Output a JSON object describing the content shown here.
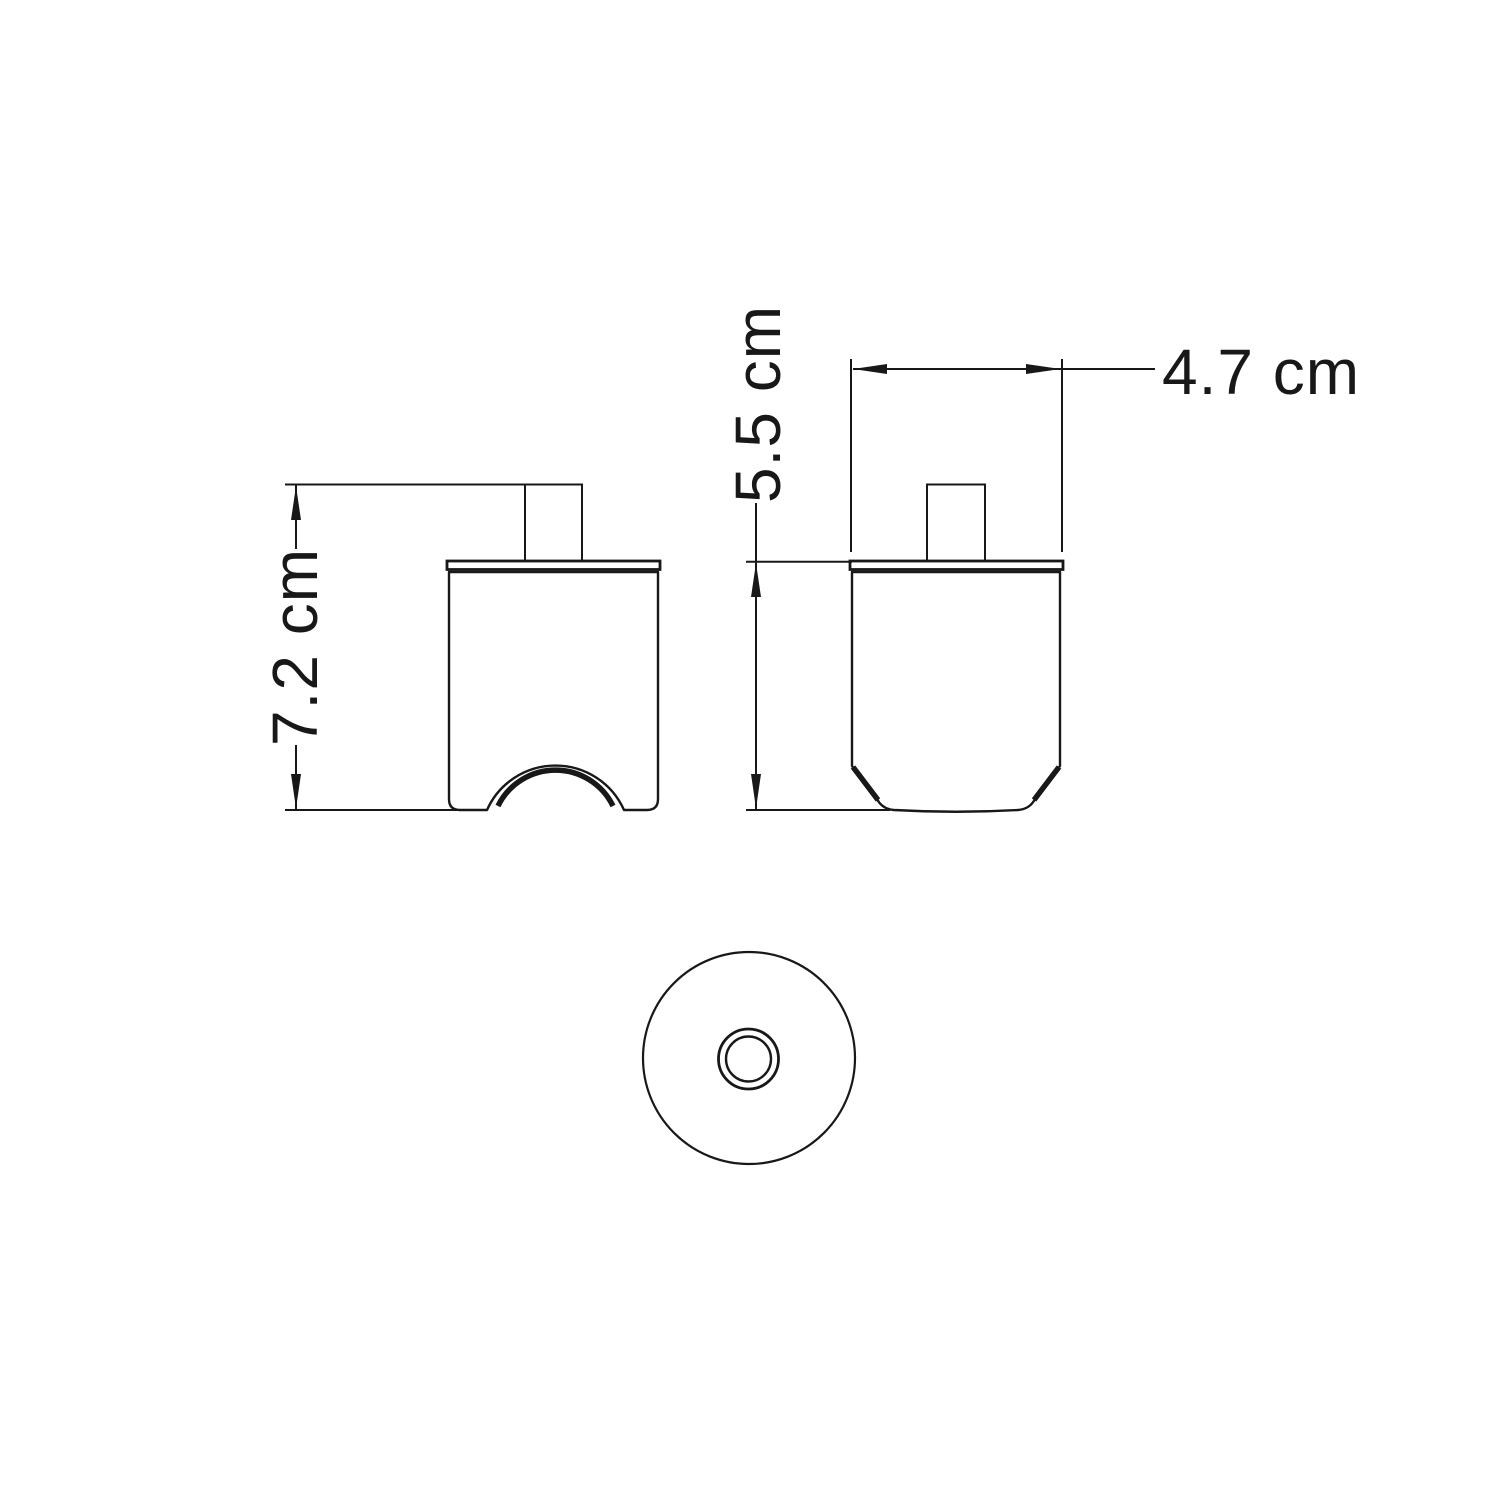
{
  "page": {
    "background": "#ffffff",
    "line_color": "#181818"
  },
  "drawing": {
    "type": "technical-dimension-drawing",
    "views": [
      {
        "id": "front",
        "name": "front view with arched cable cutout"
      },
      {
        "id": "side",
        "name": "side view with chamfered bottom corners"
      },
      {
        "id": "bottom",
        "name": "bottom view with concentric circles"
      }
    ],
    "dimensions": [
      {
        "id": "front_height",
        "label": "7.2 cm",
        "value": 7.2,
        "unit": "cm",
        "orientation": "vertical",
        "view": "front"
      },
      {
        "id": "side_height",
        "label": "5.5 cm",
        "value": 5.5,
        "unit": "cm",
        "orientation": "vertical",
        "view": "side"
      },
      {
        "id": "top_width",
        "label": "4.7 cm",
        "value": 4.7,
        "unit": "cm",
        "orientation": "horizontal",
        "view": "side"
      }
    ]
  }
}
